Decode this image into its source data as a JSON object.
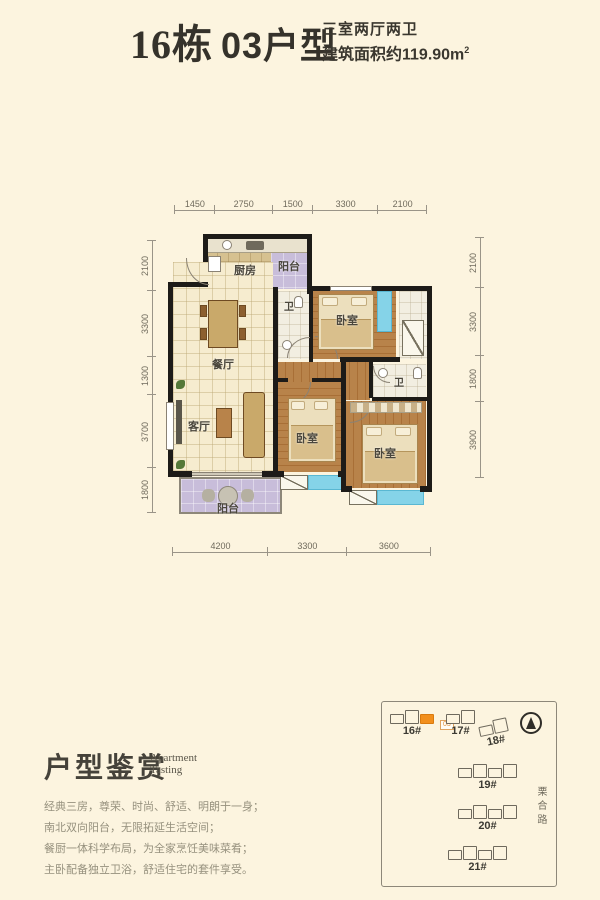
{
  "header": {
    "title_block": "16栋",
    "title_unit": "03户型",
    "layout_line": "三室两厅两卫",
    "area_text": "建筑面积约119.90m",
    "area_sup": "2"
  },
  "floorplan": {
    "rooms": {
      "kitchen": "厨房",
      "balcony_top": "阳台",
      "bath1": "卫",
      "bath2": "卫",
      "bedroom1": "卧室",
      "bedroom2": "卧室",
      "bedroom3": "卧室",
      "dining": "餐厅",
      "living": "客厅",
      "balcony_bottom": "阳台"
    },
    "dims": {
      "top": [
        1450,
        2750,
        1500,
        3300,
        2100
      ],
      "bottom": [
        4200,
        3300,
        3600
      ],
      "left": [
        2100,
        3300,
        1300,
        3700,
        1800
      ],
      "right": [
        2100,
        3300,
        1800,
        3900
      ]
    }
  },
  "footer": {
    "section_title": "户型鉴赏",
    "section_subtitle": [
      "Apartment",
      "Tasting"
    ],
    "description": [
      "经典三房，尊荣、时尚、舒适、明朗于一身；",
      "南北双向阳台，无限拓延生活空间；",
      "餐厨一体科学布局，为全家烹饪美味菜肴；",
      "主卧配备独立卫浴，舒适住宅的套件享受。"
    ]
  },
  "sitemap": {
    "buildings": [
      "16#",
      "17#",
      "18#",
      "19#",
      "20#",
      "21#"
    ],
    "highlight_tag": "03",
    "road_label": "栗合路"
  },
  "colors": {
    "background": "#fcf4df",
    "wall": "#1d1b18",
    "wood_floor": "#b8834a",
    "balcony_floor": "#c8bdda",
    "bay_window": "#85d3e8",
    "highlight_orange": "#f28f1c"
  }
}
